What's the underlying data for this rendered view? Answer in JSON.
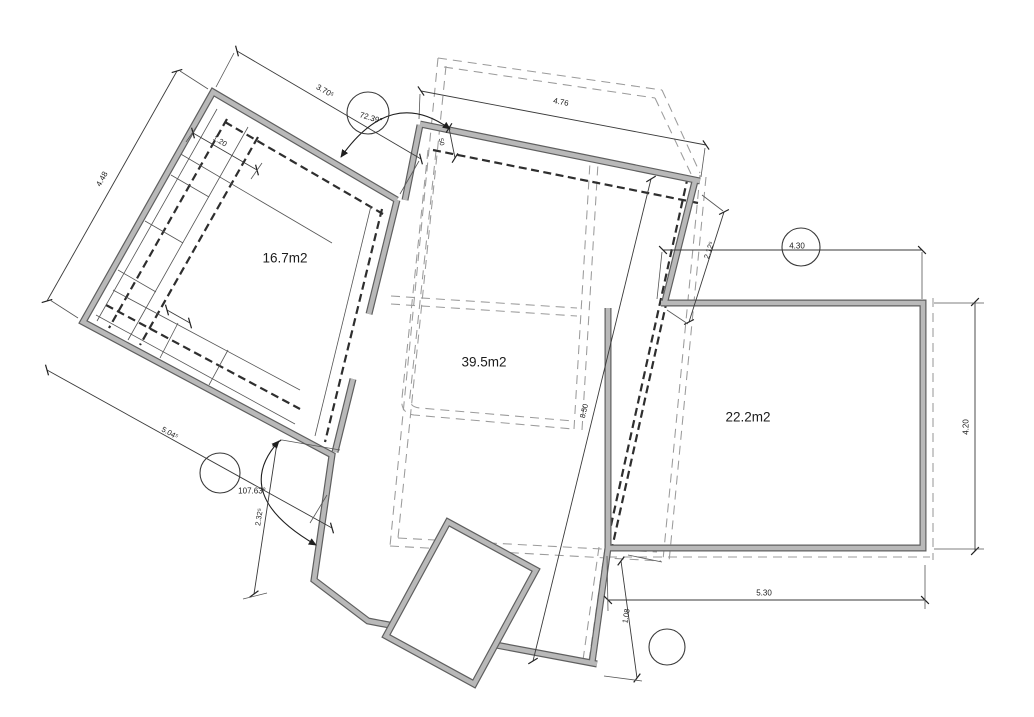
{
  "drawing": {
    "type": "architectural-floor-plan",
    "background_color": "#ffffff",
    "wall_fill_color": "#b9b9b9",
    "wall_edge_color": "#5f5f5f",
    "line_color": "#3a3a3a",
    "room_labels": [
      {
        "id": "room-area-label-1",
        "text": "16.7m2",
        "x": 285,
        "y": 258,
        "rot": 0,
        "size": 13.5
      },
      {
        "id": "room-area-label-2",
        "text": "39.5m2",
        "x": 484,
        "y": 362,
        "rot": 0,
        "size": 13.5
      },
      {
        "id": "room-area-label-3",
        "text": "22.2m2",
        "x": 748,
        "y": 417,
        "rot": 0,
        "size": 13.5
      }
    ],
    "dimension_labels": [
      {
        "id": "dim-3-70",
        "text": "3.70⁵",
        "x": 325,
        "y": 91,
        "rot": 30,
        "size": 8
      },
      {
        "id": "dim-4-48",
        "text": "4.48",
        "x": 102,
        "y": 179,
        "rot": -61,
        "size": 8
      },
      {
        "id": "dim-1-20",
        "text": "1.20",
        "x": 220,
        "y": 141,
        "rot": 30,
        "size": 7.5
      },
      {
        "id": "dim-4-76",
        "text": "4.76",
        "x": 561,
        "y": 102,
        "rot": 11,
        "size": 8
      },
      {
        "id": "dim-50",
        "text": "50",
        "x": 441,
        "y": 142,
        "rot": 78,
        "size": 6.5
      },
      {
        "id": "dim-2-12",
        "text": "2.12⁵",
        "x": 709,
        "y": 250,
        "rot": -72,
        "size": 7.5
      },
      {
        "id": "dim-4-30",
        "text": "4.30",
        "x": 797,
        "y": 246,
        "rot": 0,
        "size": 8
      },
      {
        "id": "dim-4-20",
        "text": "4.20",
        "x": 966,
        "y": 427,
        "rot": -90,
        "size": 8
      },
      {
        "id": "dim-5-30",
        "text": "5.30",
        "x": 764,
        "y": 593,
        "rot": 0,
        "size": 8
      },
      {
        "id": "dim-1-08",
        "text": "1.08",
        "x": 626,
        "y": 616,
        "rot": -80,
        "size": 7.5
      },
      {
        "id": "dim-2-32",
        "text": "2.32⁵",
        "x": 259,
        "y": 517,
        "rot": -81,
        "size": 7.5
      },
      {
        "id": "dim-5-04",
        "text": "5.04⁵",
        "x": 170,
        "y": 433,
        "rot": 29,
        "size": 7.5
      },
      {
        "id": "dim-8-50",
        "text": "8.50",
        "x": 584,
        "y": 411,
        "rot": -76,
        "size": 7.5
      }
    ],
    "angle_labels": [
      {
        "id": "angle-72-39",
        "text": "72.39°",
        "x": 371,
        "y": 118,
        "rot": 17,
        "size": 8
      },
      {
        "id": "angle-107-63",
        "text": "107.63°",
        "x": 252,
        "y": 491,
        "rot": 0,
        "size": 8
      }
    ]
  }
}
